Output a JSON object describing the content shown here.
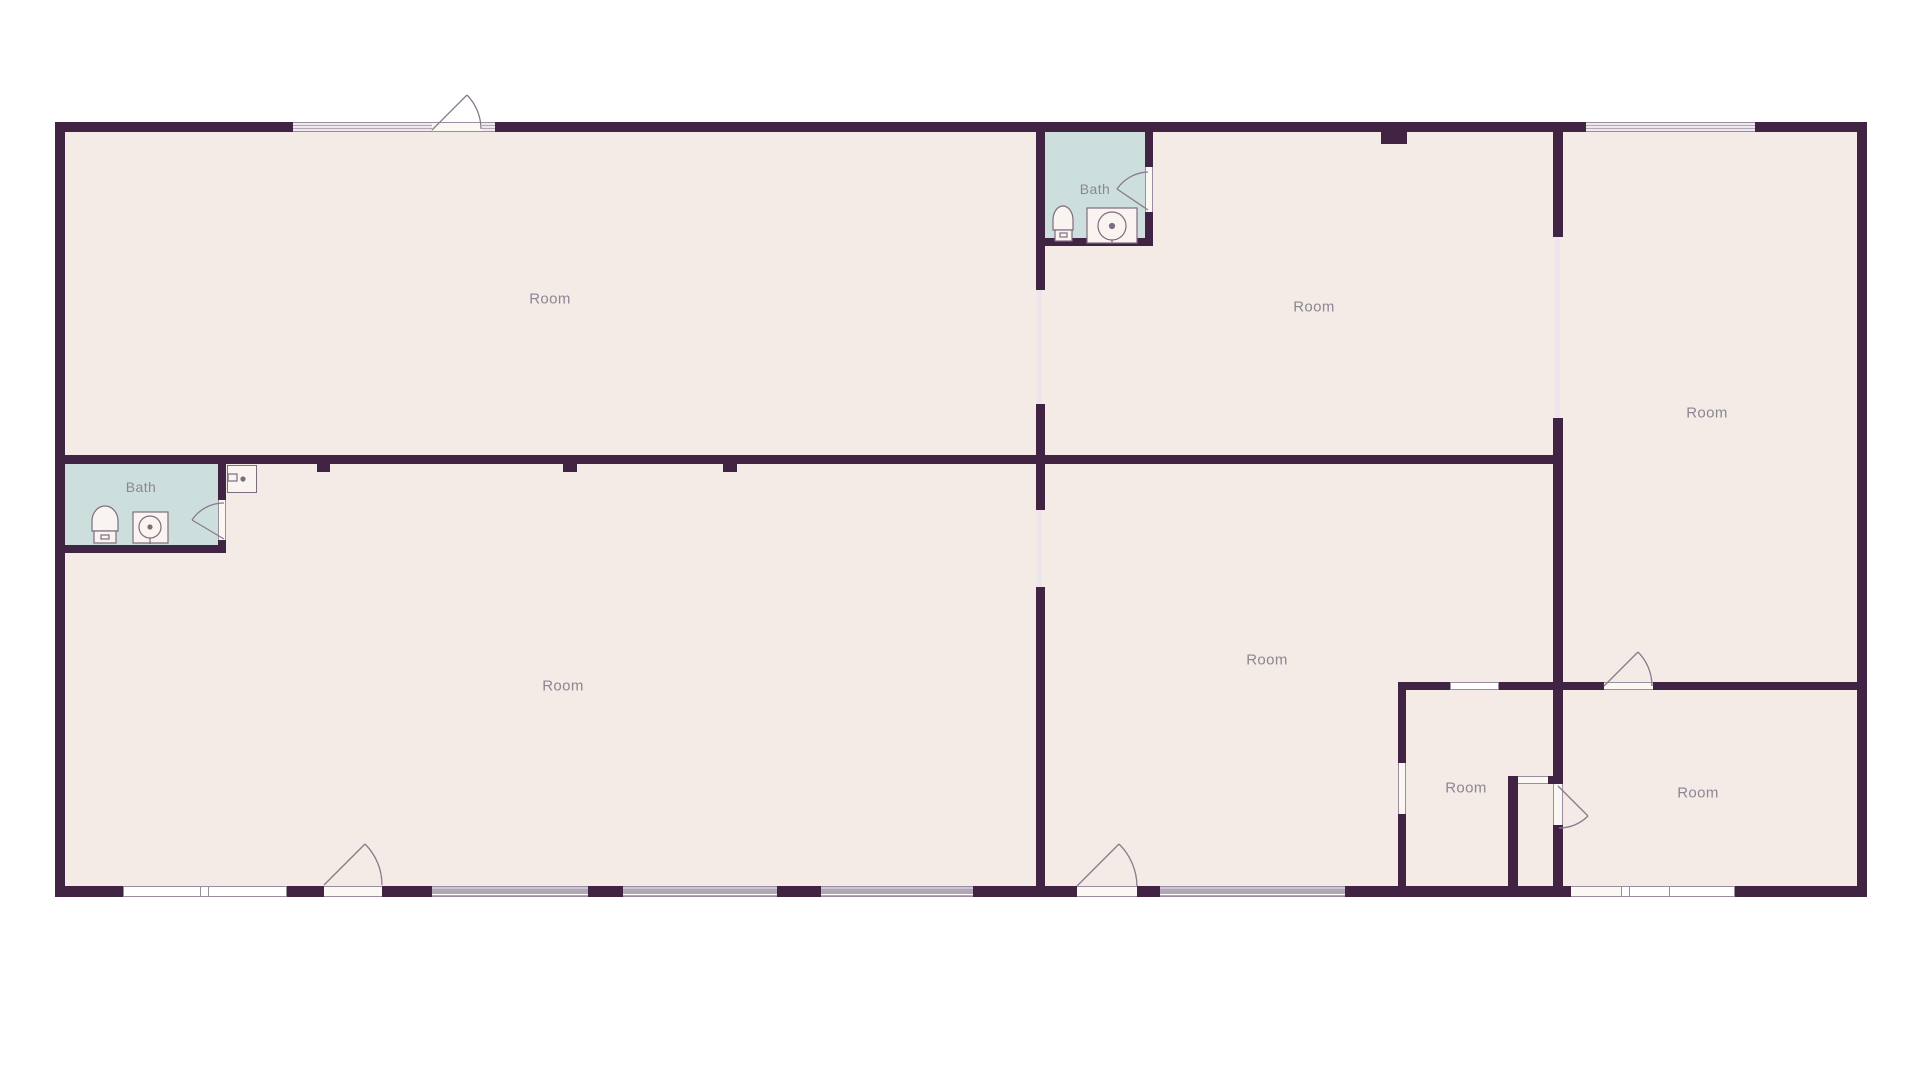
{
  "theme": {
    "background": "#ffffff",
    "floor": "#f4ebe6",
    "wall": "#412343",
    "bath_floor": "#cddfdd",
    "window_frame": "#9b8da0",
    "window_fill": "#b2a5b5",
    "opening_line": "#ece6ec",
    "door_line": "#8a7a8d",
    "fixture_line": "#7d6c80",
    "label_color": "#8a8694"
  },
  "labels": {
    "room_top_left": "Room",
    "room_top_middle": "Room",
    "room_right": "Room",
    "room_bottom_left": "Room",
    "room_bottom_middle": "Room",
    "room_small": "Room",
    "room_bottom_right": "Room",
    "bath_left": "Bath",
    "bath_top": "Bath"
  }
}
